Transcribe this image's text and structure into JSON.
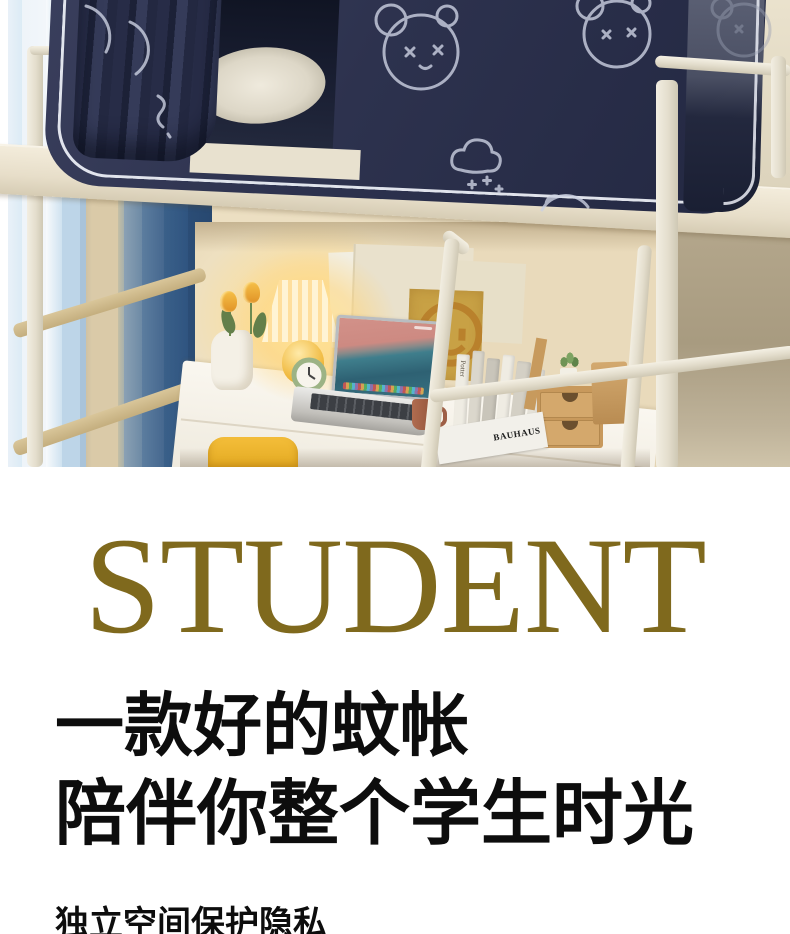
{
  "headline": {
    "text": "STUDENT",
    "color": "#7f691d"
  },
  "tagline": {
    "line1": "一款好的蚊帐",
    "line2": "陪伴你整个学生时光"
  },
  "footer_partial": {
    "text": "独立空间保护隐私"
  },
  "photo": {
    "decor_text": {
      "magazine_title": "BAUHAUS",
      "book_spine_title": "Potter"
    },
    "palette": {
      "net_navy": "#2d324e",
      "piping_white": "#eef1f8",
      "frame_cream": "#ece5d4",
      "wall_blue": "#35597f",
      "wall_tan": "#d9c9a7",
      "lamp_glow": "#ffd98f",
      "desk_white": "#f8f5ee",
      "chair_yellow": "#eeb231"
    }
  }
}
